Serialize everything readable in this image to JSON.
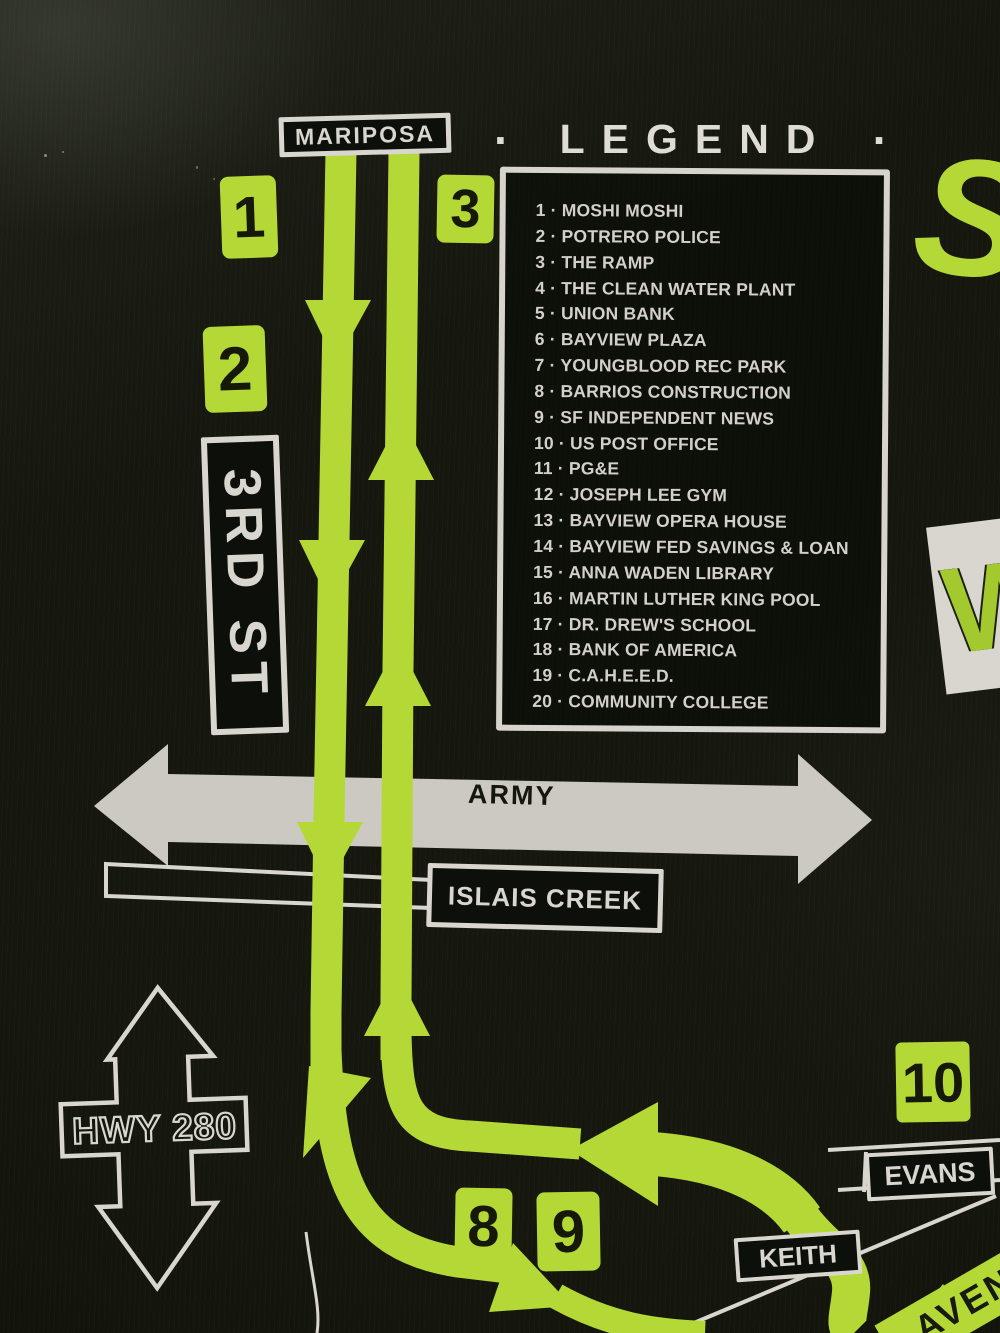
{
  "colors": {
    "route_green": "#b4d936",
    "print_white": "#d8d6cf",
    "ink_black": "#15170f",
    "fabric_black": "#16180f"
  },
  "legend": {
    "left_dot": "·",
    "title": "LEGEND",
    "right_dot": "·",
    "items": [
      "1 · MOSHI MOSHI",
      "2 · POTRERO POLICE",
      "3 · THE RAMP",
      "4 · THE CLEAN WATER PLANT",
      "5 · UNION BANK",
      "6 · BAYVIEW PLAZA",
      "7 · YOUNGBLOOD REC PARK",
      "8 · BARRIOS CONSTRUCTION",
      "9 · SF INDEPENDENT NEWS",
      "10 · US POST OFFICE",
      "11 · PG&E",
      "12 · JOSEPH LEE GYM",
      "13 · BAYVIEW OPERA HOUSE",
      "14 · BAYVIEW FED SAVINGS & LOAN",
      "15 · ANNA WADEN LIBRARY",
      "16 · MARTIN LUTHER KING POOL",
      "17 · DR. DREW'S SCHOOL",
      "18 · BANK OF AMERICA",
      "19 · C.A.H.E.E.D.",
      "20 · COMMUNITY COLLEGE"
    ]
  },
  "streets": {
    "mariposa": "MARIPOSA",
    "third_st": "3RD ST",
    "army": "ARMY",
    "islais_creek": "ISLAIS CREEK",
    "hwy_280": "HWY 280",
    "evans": "EVANS",
    "keith": "KEITH",
    "avenue_fragment": "AVEN"
  },
  "stop_markers": {
    "m1": "1",
    "m2": "2",
    "m3": "3",
    "m8": "8",
    "m9": "9",
    "m10": "10"
  },
  "edge_fragments": {
    "title_fragment": "ST",
    "logo_fragment": "W"
  }
}
